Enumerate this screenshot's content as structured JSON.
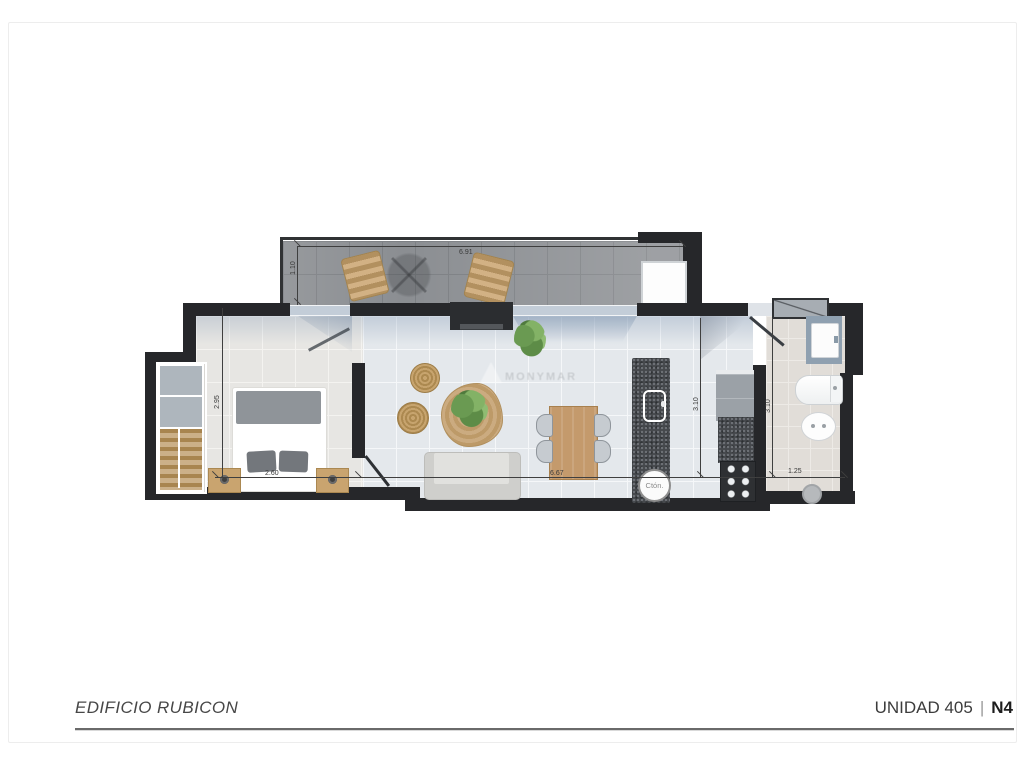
{
  "page": {
    "footer": {
      "building": "EDIFICIO RUBICON",
      "unit": "UNIDAD 405",
      "separator": "|",
      "unit_code": "N4"
    },
    "watermark": "MONYMAR"
  },
  "plan": {
    "dimensions": {
      "terrace_width": "6.91",
      "terrace_depth": "1.10",
      "bedroom_depth": "2.95",
      "bedroom_width": "2.60",
      "living_width": "6.67",
      "kitchen_depth": "3.10",
      "bathroom_depth": "3.10",
      "bathroom_width": "1.25"
    },
    "labels": {
      "water_heater": "Ctón."
    },
    "colors": {
      "wall": "#26272a",
      "terrace_floor": "#8b8e92",
      "living_floor": "#e4e8ec",
      "bedroom_floor": "#e7e6e3",
      "bathroom_floor": "#e1ddd8",
      "wood": "#c49a6c",
      "glass": "#c3cdd8"
    }
  }
}
